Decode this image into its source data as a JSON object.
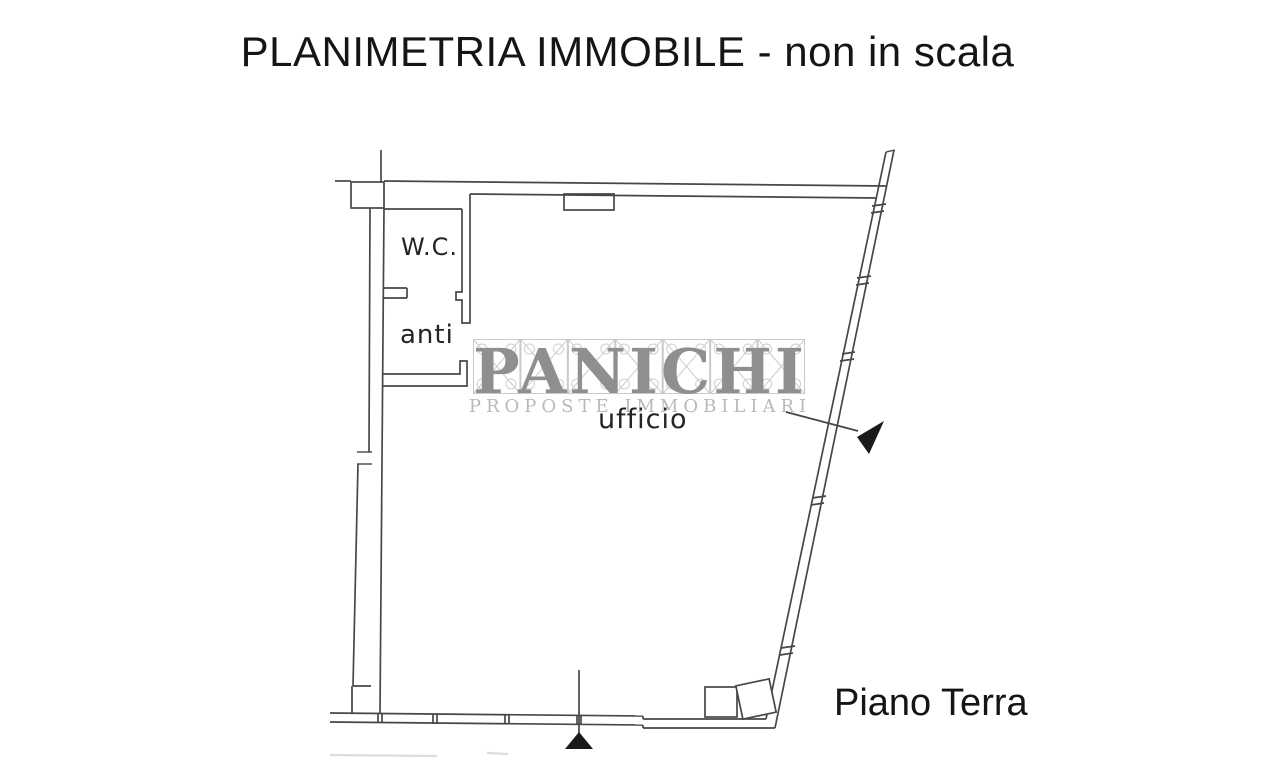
{
  "title": "PLANIMETRIA IMMOBILE - non in scala",
  "floor_label": "Piano Terra",
  "rooms": {
    "wc": "W.C.",
    "anti": "anti",
    "ufficio": "ufficio"
  },
  "watermark": {
    "brand": "PANICHI",
    "tagline": "PROPOSTE IMMOBILIARI"
  },
  "colors": {
    "background": "#ffffff",
    "plan_line": "#474747",
    "text": "#151515",
    "arrow_fill": "#1a1a1a",
    "watermark_brand": "#8f8f8f",
    "watermark_tagline": "#b9b9b9",
    "watermark_lattice": "#c9c9c9"
  }
}
